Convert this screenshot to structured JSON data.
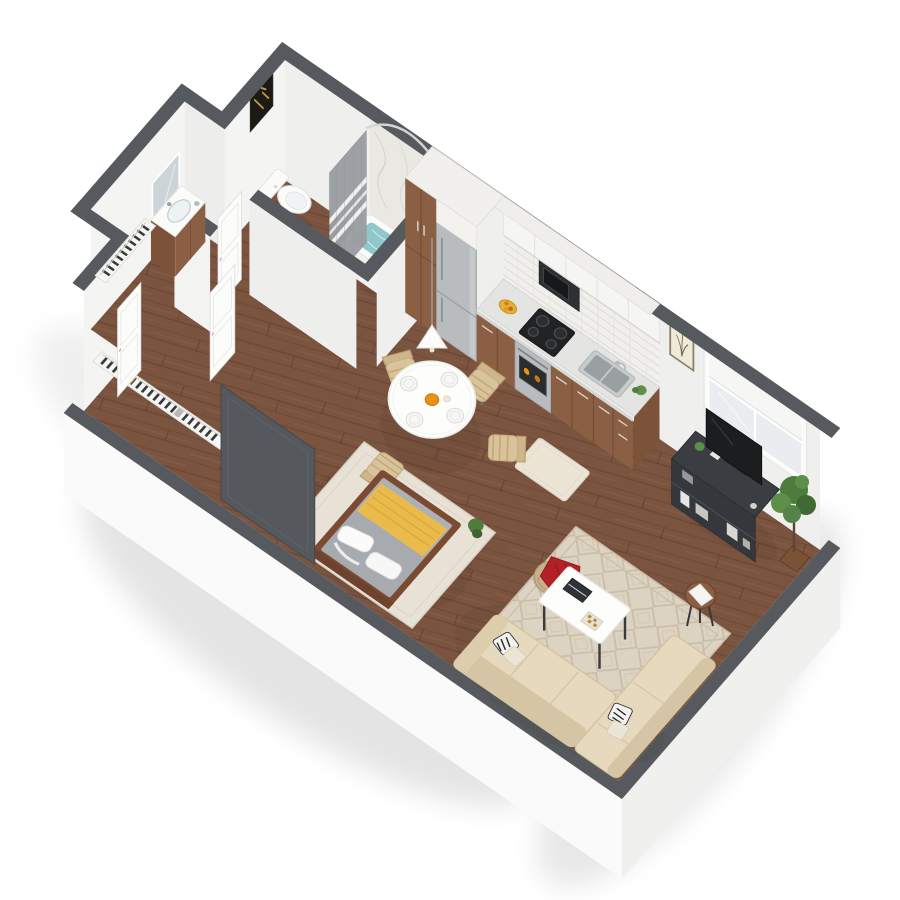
{
  "scene": {
    "view": "isometric-3d-dollhouse-floorplan",
    "unit": "studio apartment",
    "rooms": [
      {
        "name": "bathroom",
        "items": [
          "vanity-sink",
          "mirror",
          "toilet",
          "shower-pan",
          "rolled-towel",
          "bathtub-with-water",
          "shower-curtain",
          "curtain-rod",
          "marble-shower-wall",
          "dark-wall-art"
        ]
      },
      {
        "name": "entry-hall-closet",
        "items": [
          "wire-closet-shelving",
          "hanging-clothes",
          "white-panel-doors",
          "dark-sliding-panel"
        ]
      },
      {
        "name": "kitchen",
        "items": [
          "tall-pantry-cabinet",
          "stainless-refrigerator",
          "upper-cabinets",
          "microwave",
          "tile-backsplash",
          "range-oven",
          "cooktop",
          "countertop",
          "sink",
          "fruit-bowl",
          "counter-plant",
          "kitchen-rug"
        ]
      },
      {
        "name": "dining-area",
        "items": [
          "round-pedestal-table",
          "place-settings",
          "juice-pitcher",
          "woven-chairs",
          "pendant-lamp"
        ]
      },
      {
        "name": "sleeping-area",
        "items": [
          "platform-bed",
          "gray-mattress",
          "yellow-runner-blanket",
          "white-pillows",
          "bed-area-rug",
          "small-floor-plant"
        ]
      },
      {
        "name": "living-area",
        "items": [
          "diamond-pattern-rug",
          "beige-sectional-sofa",
          "patterned-pillows",
          "white-coffee-table",
          "books",
          "checkerboard",
          "pouf-ottoman",
          "red-throw",
          "side-table",
          "tv-stand",
          "television",
          "potted-plant",
          "window-with-shade",
          "botanical-art"
        ]
      }
    ]
  },
  "palette": {
    "wall_face": "#f4f4f3",
    "wall_face_shade": "#e9e9e8",
    "wall_cap": "#565a5e",
    "outer_band": "#fafafa",
    "outer_band_shade": "#f0f0ef",
    "floor_wood": "#7b5440",
    "cabinet_wood": "#8a5f43",
    "cabinet_wood_light": "#9a6c4c",
    "cabinet_wood_dark": "#7c5238",
    "counter": "#e4e4e2",
    "upper_cabinet": "#f5f5f3",
    "stainless": "#b8bcbe",
    "appliance_dark": "#2e3134",
    "tub_water": "#8ec8cb",
    "porcelain": "#fbfbfa",
    "curtain_gray": "#9b9ea3",
    "marble": "#eae8e3",
    "mirror_glass": "#ccd4d8",
    "door_white": "#fcfcfb",
    "dark_panel": "#55585c",
    "rug_living": "#ddd3c2",
    "rug_living_pattern": "#c7b9a0",
    "rug_bed": "#e8e2d6",
    "rug_kitchen": "#ece5d6",
    "mattress_gray": "#a7abaf",
    "blanket_yellow": "#eaba4b",
    "bed_frame_wood": "#7a4a33",
    "sofa_beige": "#e6d9bd",
    "sofa_shade": "#d5c5a4",
    "pouf_tan": "#c8b08a",
    "throw_red": "#b32025",
    "table_white": "#fdfdfc",
    "chair_weave": "#d9c39a",
    "chair_weave_dark": "#cfb58c",
    "tv_stand_dark": "#3a3d41",
    "tv_screen": "#1b1d1f",
    "plant_green": "#4d7c3d",
    "plant_green_light": "#5d8f4a",
    "accent_orange": "#e8920f",
    "art_dark": "#1d1a16",
    "art_gold": "#c29a4a"
  }
}
